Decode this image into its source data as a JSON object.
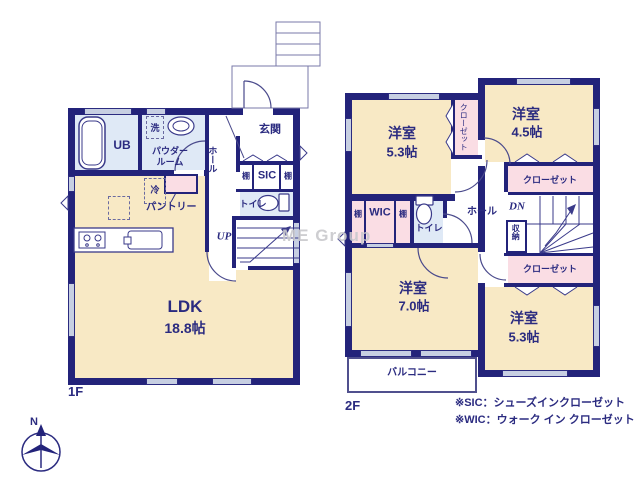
{
  "watermark": "ME Group",
  "floor1": {
    "label": "1F",
    "ldk": "LDK",
    "ldk_size": "18.8帖",
    "ub": "UB",
    "washer": "洗",
    "powder_line1": "パウダー",
    "powder_line2": "ルーム",
    "hall": "ホール",
    "entrance": "玄関",
    "shelf": "棚",
    "sic": "SIC",
    "toilet": "トイレ",
    "fridge": "冷",
    "pantry": "パントリー",
    "stairs_up": "UP"
  },
  "floor2": {
    "label": "2F",
    "bed1": "洋室",
    "bed1_size": "5.3帖",
    "bed2": "洋室",
    "bed2_size": "4.5帖",
    "bed3": "洋室",
    "bed3_size": "7.0帖",
    "bed4": "洋室",
    "bed4_size": "5.3帖",
    "closet": "クローゼット",
    "wic": "WIC",
    "shelf": "棚",
    "toilet": "トイレ",
    "hall": "ホール",
    "stairs_dn": "DN",
    "storage": "収納",
    "balcony": "バルコニー"
  },
  "notes": {
    "sic": "※SIC：シューズインクローゼット",
    "wic": "※WIC：ウォーク イン クローゼット"
  },
  "compass": {
    "north": "N"
  },
  "colors": {
    "wall": "#23237a",
    "text": "#2b2b80",
    "room_cream": "#f8e9c5",
    "room_blue": "#dfe9f6",
    "room_pink": "#fadde4",
    "window_gray": "#c7cfe2",
    "watermark_gray": "#c9c9cd"
  }
}
